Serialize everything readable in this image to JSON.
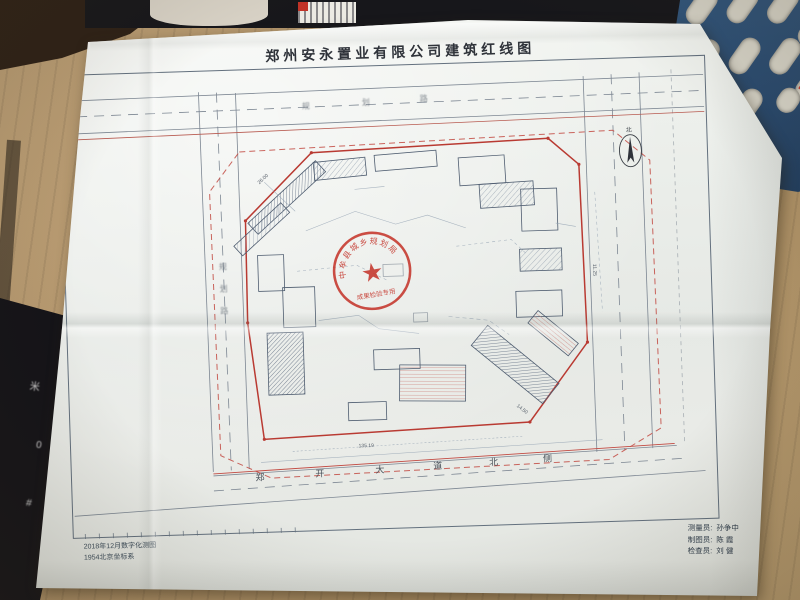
{
  "scene": {
    "black_object_glyphs": [
      "米",
      "0",
      "#"
    ]
  },
  "drawing": {
    "title": "郑州安永置业有限公司建筑红线图",
    "notes": [
      "2018年12月数字化测图",
      "1954北京坐标系"
    ],
    "credits": [
      {
        "label": "测量员:",
        "name": "孙争中"
      },
      {
        "label": "制图员:",
        "name": "陈 霞"
      },
      {
        "label": "检查员:",
        "name": "刘 健"
      }
    ],
    "roads": {
      "bottom_chars": [
        "郑",
        "开",
        "大",
        "道",
        "北",
        "侧"
      ],
      "top_chars": [
        "规",
        "划",
        "路"
      ],
      "left_chars": [
        "规",
        "划",
        "路"
      ]
    },
    "north_label": "北",
    "stamp": {
      "arc_text": "中牟县城乡规划局",
      "banner_text": "成果检验专用",
      "star": "★"
    },
    "dims": [
      "14.50",
      "135.19",
      "26.00",
      "11.25"
    ],
    "colors": {
      "redline": "#b93a32",
      "stamp_red": "#c5362c",
      "line_grey": "#63707e"
    }
  }
}
